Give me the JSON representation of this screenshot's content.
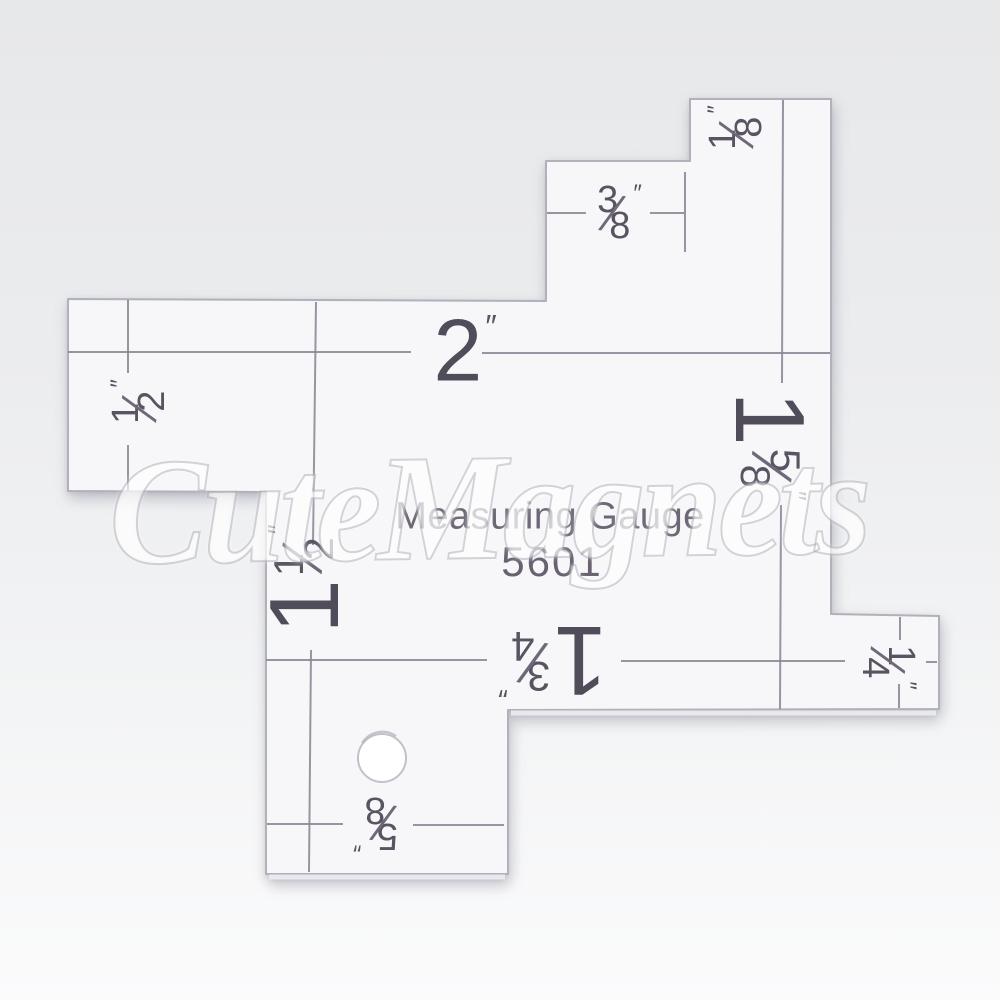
{
  "watermark": {
    "text": "CuteMagnets"
  },
  "plate": {
    "title": "Measuring Gauge",
    "model": "5601"
  },
  "ui": {
    "fraction_slash": "⁄"
  },
  "labels": {
    "three_eighths": {
      "num": "3",
      "den": "8",
      "prime": "″"
    },
    "one_eighth": {
      "num": "1",
      "den": "8",
      "prime": "″"
    },
    "two_inch": {
      "whole": "2",
      "prime": "″"
    },
    "half_inch": {
      "num": "1",
      "den": "2",
      "prime": "″"
    },
    "one_five_eighths": {
      "whole": "1",
      "num": "5",
      "den": "8",
      "prime": "″"
    },
    "one_and_a_half": {
      "whole": "1",
      "num": "1",
      "den": "2",
      "prime": "″"
    },
    "one_three_quarters": {
      "whole": "1",
      "num": "3",
      "den": "4",
      "prime": "″"
    },
    "one_quarter": {
      "num": "1",
      "den": "4",
      "prime": "″"
    },
    "five_eighths": {
      "num": "5",
      "den": "8",
      "prime": "″"
    }
  },
  "colors": {
    "plate": "#f7f7f9",
    "plate_edge": "#b2b0ba",
    "printed_line": "#8a8393",
    "ink": "#595462",
    "background_top": "#e7e8ea",
    "background_bottom": "#fbfbfc"
  }
}
